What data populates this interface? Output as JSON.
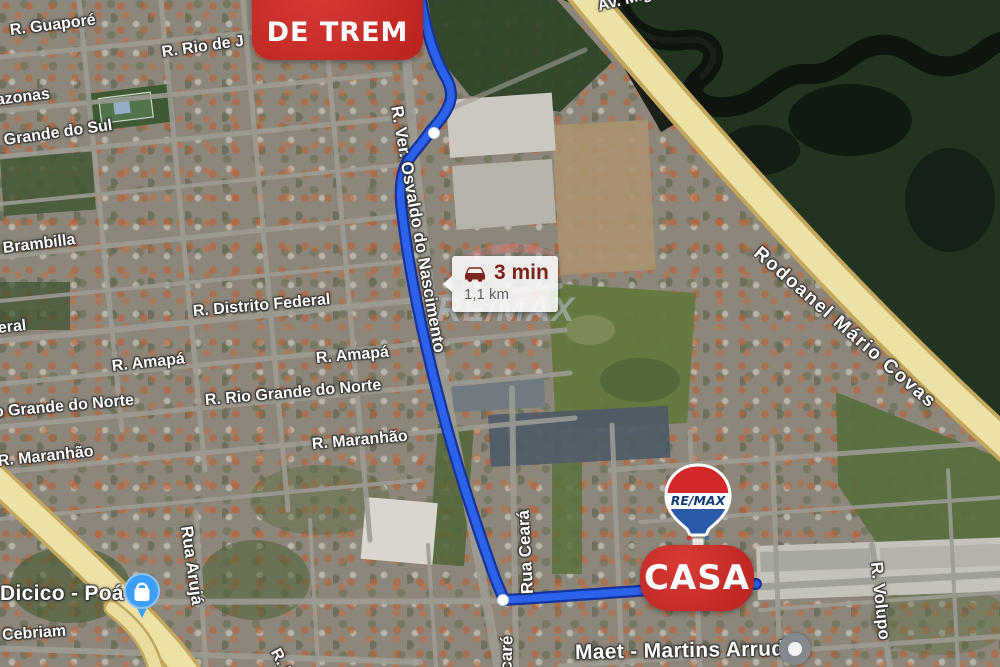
{
  "map": {
    "markers": {
      "origin_badge": {
        "line1_partial": "Ç",
        "label": "DE TREM",
        "bg": "#cd312e"
      },
      "destination_badge": {
        "label": "CASA",
        "bg": "#c5302d"
      },
      "remax_balloon": {
        "brand": "RE/MAX",
        "top_color": "#d2282a",
        "band_color": "#ffffff",
        "bottom_color": "#2b5aa8",
        "text_color": "#123a75"
      },
      "store_poi": {
        "label": "Dicico - Poá",
        "icon": "shopping-bag-icon",
        "color": "#3d9ef6"
      },
      "transit_poi": {
        "icon": "circle-icon",
        "color": "#84898e"
      },
      "route_tooltip": {
        "icon": "car-icon",
        "duration": "3 min",
        "distance": "1,1 km"
      }
    },
    "watermark": {
      "brand": "RE/MAX"
    },
    "colors": {
      "route": "#2c62ea",
      "route_casing": "#16339e",
      "highway_fill": "#eee1a6",
      "highway_edge": "#c3a75c",
      "badge_red": "#cd312e",
      "forest": "#223420",
      "river": "#0d140e"
    },
    "street_labels": [
      {
        "text": "R. Guaporé",
        "x": 10,
        "y": 22,
        "rot": -7,
        "cls": "street"
      },
      {
        "text": "R. Rio de J",
        "x": 162,
        "y": 44,
        "rot": -8,
        "cls": "street"
      },
      {
        "text": "azonas",
        "x": -4,
        "y": 92,
        "rot": -7,
        "cls": "street"
      },
      {
        "text": "Grande do Sul",
        "x": 4,
        "y": 132,
        "rot": -8,
        "cls": "street"
      },
      {
        "text": "Brambilla",
        "x": 3,
        "y": 240,
        "rot": -7,
        "cls": "street"
      },
      {
        "text": "R. Distrito Federal",
        "x": 193,
        "y": 303,
        "rot": -5,
        "cls": "street"
      },
      {
        "text": "eral",
        "x": -2,
        "y": 320,
        "rot": -6,
        "cls": "street"
      },
      {
        "text": "R. Amapá",
        "x": 112,
        "y": 358,
        "rot": -6,
        "cls": "street"
      },
      {
        "text": "R. Amapá",
        "x": 316,
        "y": 350,
        "rot": -5,
        "cls": "street"
      },
      {
        "text": "o Grande do Norte",
        "x": -6,
        "y": 404,
        "rot": -5,
        "cls": "street"
      },
      {
        "text": "R. Rio Grande do Norte",
        "x": 205,
        "y": 392,
        "rot": -5,
        "cls": "street"
      },
      {
        "text": "R. Maranhão",
        "x": -2,
        "y": 453,
        "rot": -6,
        "cls": "street"
      },
      {
        "text": "R. Maranhão",
        "x": 312,
        "y": 436,
        "rot": -5,
        "cls": "street"
      },
      {
        "text": "o Cebriam",
        "x": -12,
        "y": 628,
        "rot": -4,
        "cls": "street"
      },
      {
        "text": "Av. Mig",
        "x": 598,
        "y": -2,
        "rot": -14,
        "cls": "street"
      },
      {
        "text": "R. Ri",
        "x": 274,
        "y": 641,
        "rot": 62,
        "cls": "street"
      },
      {
        "text": "R. Ver. Osvaldo do Nascimento",
        "x": 396,
        "y": 96,
        "rot": 80,
        "cls": "street-v"
      },
      {
        "text": "Rua Ceará",
        "x": 528,
        "y": 584,
        "rot": -93,
        "cls": "street-v"
      },
      {
        "text": "acaré",
        "x": 506,
        "y": 670,
        "rot": -88,
        "cls": "street-v"
      },
      {
        "text": "Rua Arujá",
        "x": 186,
        "y": 516,
        "rot": 82,
        "cls": "street-v"
      },
      {
        "text": "R. Volupo",
        "x": 876,
        "y": 552,
        "rot": 84,
        "cls": "street-v"
      },
      {
        "text": "Rodoanel Mário Covas",
        "x": 756,
        "y": 240,
        "rot": 41,
        "cls": "hwy"
      },
      {
        "text": "Maet - Martins Arruda,",
        "x": 575,
        "y": 641,
        "rot": -1,
        "cls": "poi"
      },
      {
        "text": "Dicico - Poá",
        "x": 0,
        "y": 582,
        "rot": 0,
        "cls": "poi"
      }
    ]
  }
}
